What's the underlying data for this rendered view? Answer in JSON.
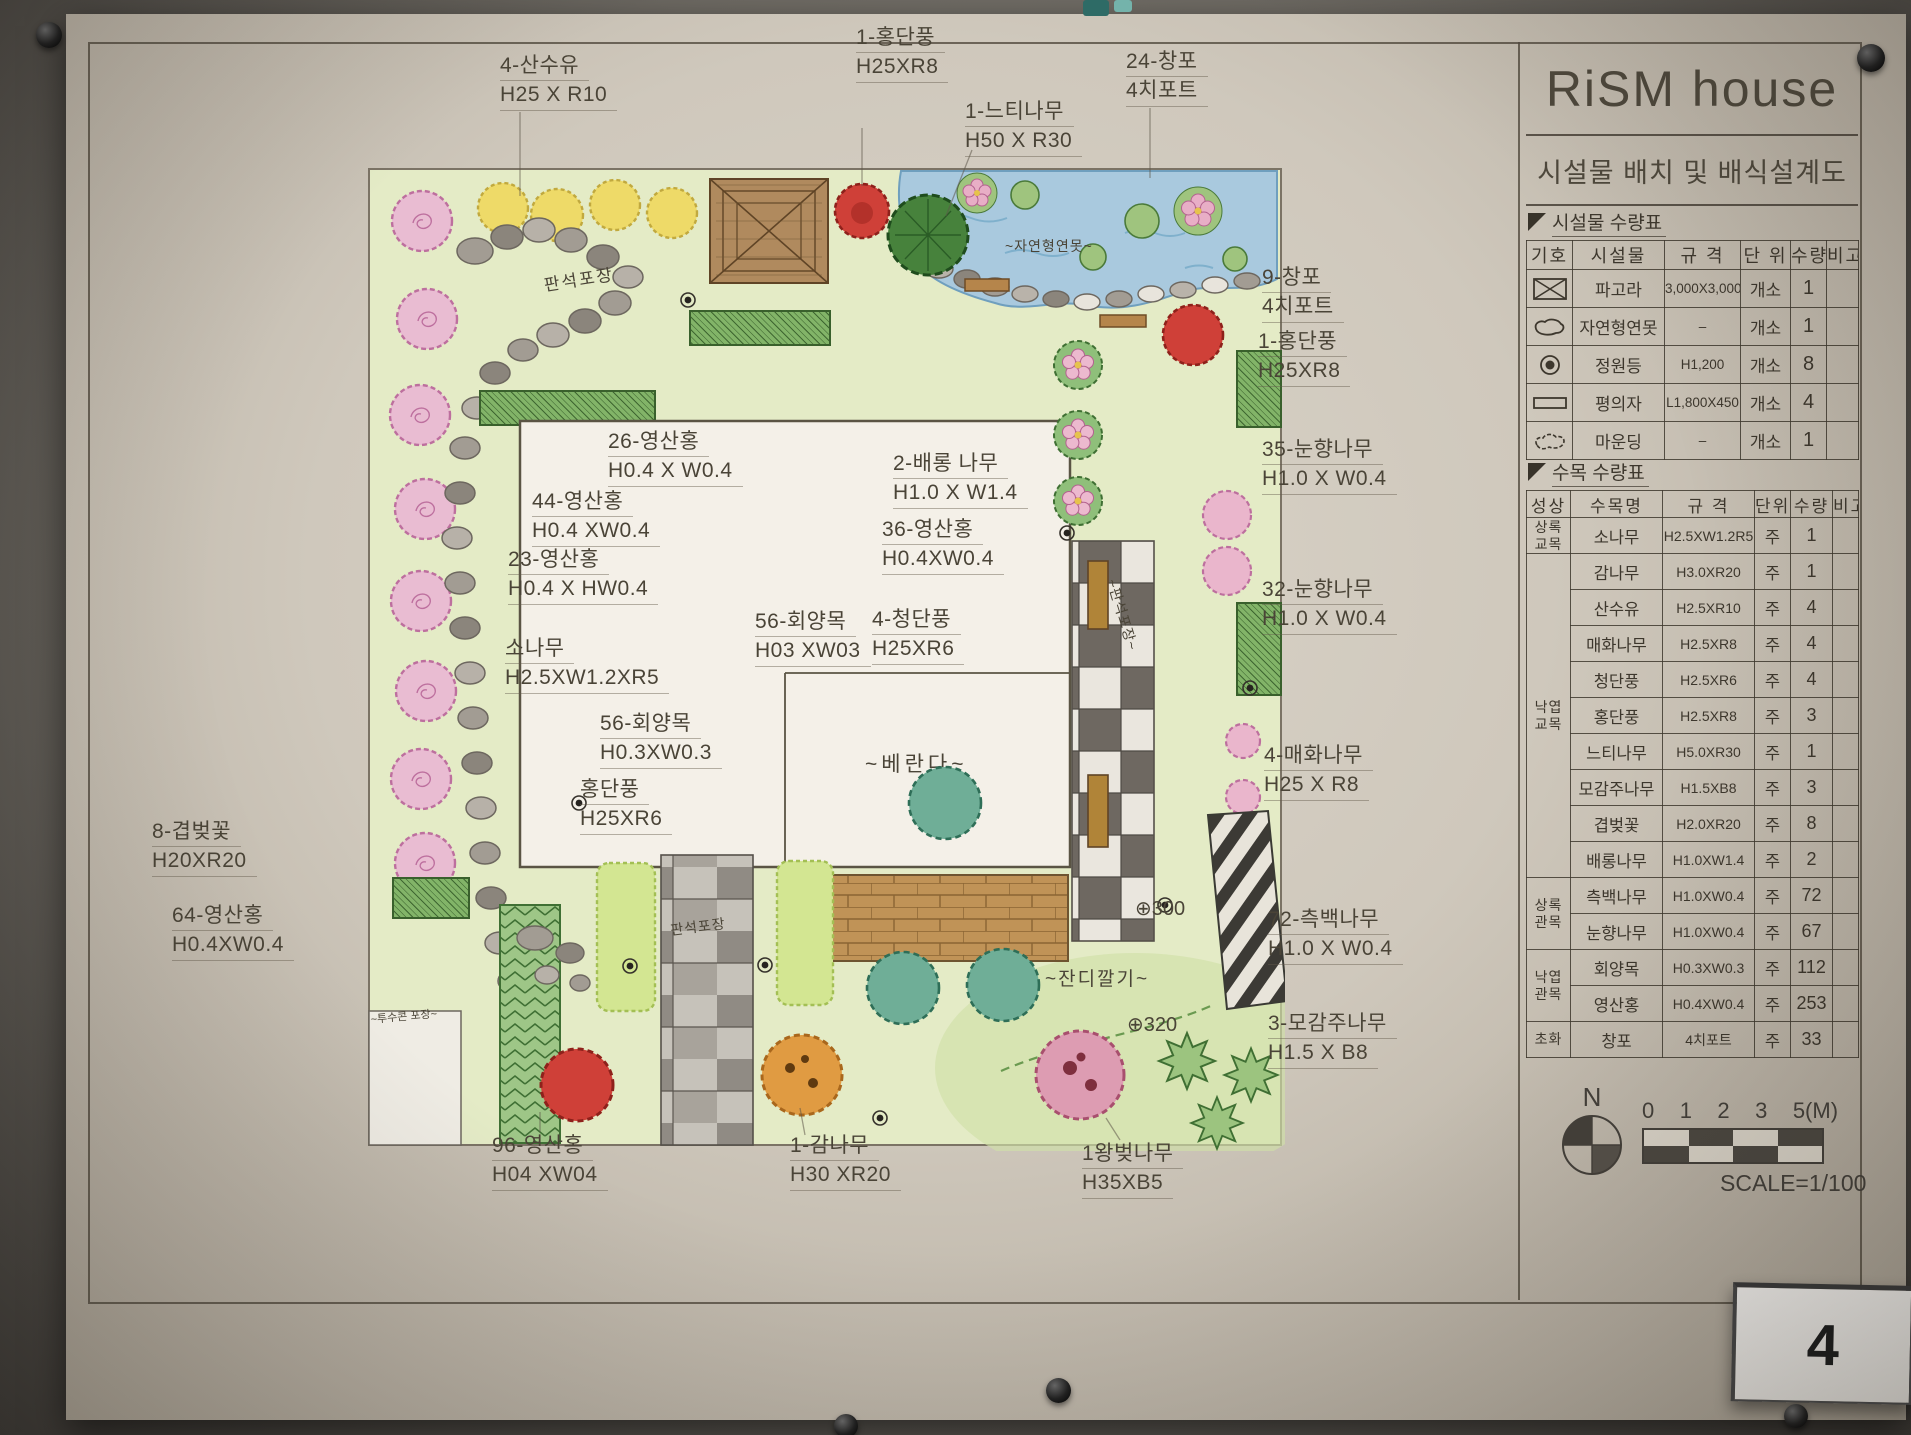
{
  "title_block": {
    "title": "RiSM house",
    "subtitle": "시설물 배치 및 배식설계도"
  },
  "facility_table": {
    "caption": "시설물 수량표",
    "headers": [
      "기호",
      "시설물",
      "규 격",
      "단 위",
      "수량",
      "비고"
    ],
    "rows": [
      {
        "symbol": "pergola",
        "name": "파고라",
        "size": "3,000X3,000",
        "unit": "개소",
        "qty": "1",
        "note": ""
      },
      {
        "symbol": "natural-pond",
        "name": "자연형연못",
        "size": "–",
        "unit": "개소",
        "qty": "1",
        "note": ""
      },
      {
        "symbol": "garden-light",
        "name": "정원등",
        "size": "H1,200",
        "unit": "개소",
        "qty": "8",
        "note": ""
      },
      {
        "symbol": "bench",
        "name": "평의자",
        "size": "L1,800X450",
        "unit": "개소",
        "qty": "4",
        "note": ""
      },
      {
        "symbol": "mounding",
        "name": "마운딩",
        "size": "–",
        "unit": "개소",
        "qty": "1",
        "note": ""
      }
    ]
  },
  "tree_table": {
    "caption": "수목 수량표",
    "headers": [
      "성상",
      "수목명",
      "규 격",
      "단위",
      "수량",
      "비고"
    ],
    "rows": [
      {
        "cat": "상록\n교목",
        "catspan": 1,
        "name": "소나무",
        "size": "H2.5XW1.2R5",
        "unit": "주",
        "qty": "1"
      },
      {
        "cat": "낙엽\n교목",
        "catspan": 9,
        "name": "감나무",
        "size": "H3.0XR20",
        "unit": "주",
        "qty": "1"
      },
      {
        "name": "산수유",
        "size": "H2.5XR10",
        "unit": "주",
        "qty": "4"
      },
      {
        "name": "매화나무",
        "size": "H2.5XR8",
        "unit": "주",
        "qty": "4"
      },
      {
        "name": "청단풍",
        "size": "H2.5XR6",
        "unit": "주",
        "qty": "4"
      },
      {
        "name": "홍단풍",
        "size": "H2.5XR8",
        "unit": "주",
        "qty": "3"
      },
      {
        "name": "느티나무",
        "size": "H5.0XR30",
        "unit": "주",
        "qty": "1"
      },
      {
        "name": "모감주나무",
        "size": "H1.5XB8",
        "unit": "주",
        "qty": "3"
      },
      {
        "name": "겹벚꽃",
        "size": "H2.0XR20",
        "unit": "주",
        "qty": "8"
      },
      {
        "name": "배롱나무",
        "size": "H1.0XW1.4",
        "unit": "주",
        "qty": "2"
      },
      {
        "cat": "상록\n관목",
        "catspan": 2,
        "name": "측백나무",
        "size": "H1.0XW0.4",
        "unit": "주",
        "qty": "72"
      },
      {
        "name": "눈향나무",
        "size": "H1.0XW0.4",
        "unit": "주",
        "qty": "67"
      },
      {
        "cat": "낙엽\n관목",
        "catspan": 2,
        "name": "회양목",
        "size": "H0.3XW0.3",
        "unit": "주",
        "qty": "112"
      },
      {
        "name": "영산홍",
        "size": "H0.4XW0.4",
        "unit": "주",
        "qty": "253"
      },
      {
        "cat": "초화",
        "catspan": 1,
        "name": "창포",
        "size": "4치포트",
        "unit": "주",
        "qty": "33"
      }
    ]
  },
  "plan_labels": [
    {
      "id": "sansuyu",
      "name": "4-산수유",
      "spec": "H25 X R10",
      "x": 500,
      "y": 52
    },
    {
      "id": "hongdanpung-top",
      "name": "1-홍단풍",
      "spec": "H25XR8",
      "x": 856,
      "y": 24
    },
    {
      "id": "neutinamu",
      "name": "1-느티나무",
      "spec": "H50 X R30",
      "x": 965,
      "y": 98
    },
    {
      "id": "changpo-top",
      "name": "24-창포",
      "spec": "4치포트",
      "x": 1126,
      "y": 48
    },
    {
      "id": "changpo-right",
      "name": "9-창포",
      "spec": "4치포트",
      "x": 1262,
      "y": 264
    },
    {
      "id": "hongdanpung-right",
      "name": "1-홍단풍",
      "spec": "H25XR8",
      "x": 1258,
      "y": 328
    },
    {
      "id": "nunhyang-35",
      "name": "35-눈향나무",
      "spec": "H1.0 X W0.4",
      "x": 1262,
      "y": 436
    },
    {
      "id": "nunhyang-32",
      "name": "32-눈향나무",
      "spec": "H1.0 X W0.4",
      "x": 1262,
      "y": 576
    },
    {
      "id": "maehwa",
      "name": "4-매화나무",
      "spec": "H25 X R8",
      "x": 1264,
      "y": 742
    },
    {
      "id": "cheukbaek",
      "name": "72-측백나무",
      "spec": "H1.0 X W0.4",
      "x": 1268,
      "y": 906
    },
    {
      "id": "mogamju",
      "name": "3-모감주나무",
      "spec": "H1.5 X B8",
      "x": 1268,
      "y": 1010
    },
    {
      "id": "gyeopbeotkkot",
      "name": "8-겹벚꽃",
      "spec": "H20XR20",
      "x": 152,
      "y": 818
    },
    {
      "id": "yeongsanhong-64",
      "name": "64-영산홍",
      "spec": "H0.4XW0.4",
      "x": 172,
      "y": 902
    },
    {
      "id": "yeongsanhong-26",
      "name": "26-영산홍",
      "spec": "H0.4 X W0.4",
      "x": 608,
      "y": 428
    },
    {
      "id": "yeongsanhong-44",
      "name": "44-영산홍",
      "spec": "H0.4 XW0.4",
      "x": 532,
      "y": 488
    },
    {
      "id": "yeongsanhong-23",
      "name": "23-영산홍",
      "spec": "H0.4 X HW0.4",
      "x": 508,
      "y": 546
    },
    {
      "id": "sonamu",
      "name": "소나무",
      "spec": "H2.5XW1.2XR5",
      "x": 505,
      "y": 635
    },
    {
      "id": "hoeyangmok-56a",
      "name": "56-회양목",
      "spec": "H03 XW03",
      "x": 755,
      "y": 608
    },
    {
      "id": "cheongdanpung",
      "name": "4-청단풍",
      "spec": "H25XR6",
      "x": 872,
      "y": 606
    },
    {
      "id": "baerongnamu",
      "name": "2-배롱 나무",
      "spec": "H1.0 X W1.4",
      "x": 893,
      "y": 450
    },
    {
      "id": "yeongsanhong-36",
      "name": "36-영산홍",
      "spec": "H0.4XW0.4",
      "x": 882,
      "y": 516
    },
    {
      "id": "hoeyangmok-56b",
      "name": "56-회양목",
      "spec": "H0.3XW0.3",
      "x": 600,
      "y": 710
    },
    {
      "id": "hongdanpung-mid",
      "name": "홍단풍",
      "spec": "H25XR6",
      "x": 580,
      "y": 776
    },
    {
      "id": "yeongsanhong-96",
      "name": "96-영산홍",
      "spec": "H04 XW04",
      "x": 492,
      "y": 1132
    },
    {
      "id": "gamnamu",
      "name": "1-감나무",
      "spec": "H30 XR20",
      "x": 790,
      "y": 1132
    },
    {
      "id": "wangbeotnamu",
      "name": "1왕벚나무",
      "spec": "H35XB5",
      "x": 1082,
      "y": 1140
    }
  ],
  "plan_annotations": {
    "pond": "~자연형연못~",
    "stepping_path": "판석포장",
    "slab_path": "~판석포장~",
    "block_path": "판석포장",
    "porous_paving": "~투수콘 포장~",
    "lawn": "~잔디깔기~",
    "veranda": "~베란다~",
    "dia_300": "⊕300",
    "dia_320": "⊕320"
  },
  "compass": {
    "north": "N"
  },
  "scale_bar": {
    "ticks": [
      "0",
      "1",
      "2",
      "3",
      "5(M)"
    ],
    "label": "SCALE=1/100"
  },
  "page_number": "4",
  "palette": {
    "paper": "#cfc8bc",
    "pencil": "#4a4437",
    "ground": "#e4ebc6",
    "pond": "#a9c9de",
    "pink_shrub": "#e9bcd2",
    "hedge_green": "#82b468",
    "brick": "#c09357",
    "red_tree": "#cf4038"
  }
}
